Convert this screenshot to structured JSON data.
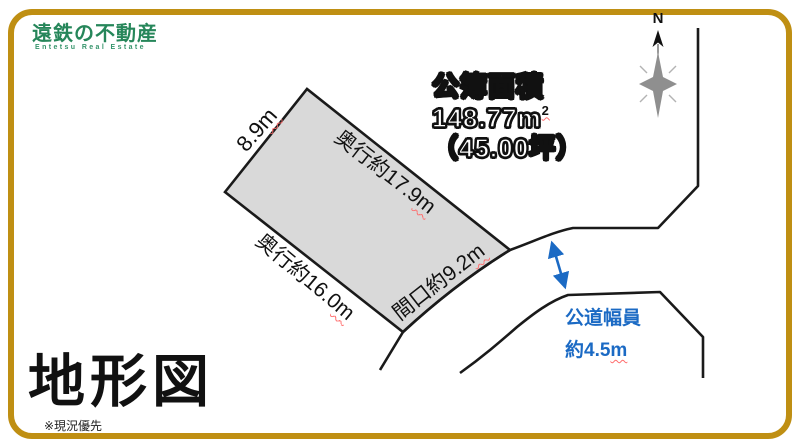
{
  "logo": {
    "jp": "遠鉄の不動産",
    "en": "Entetsu Real Estate"
  },
  "compass": {
    "label": "N"
  },
  "area": {
    "title": "公簿面積",
    "m2_value": "148.77m",
    "m2_sup": "2",
    "tsubo": "（45.00坪）"
  },
  "plot": {
    "edge_left": {
      "text": "8.9",
      "unit": "m"
    },
    "edge_top": {
      "text": "奥行約17.9",
      "unit": "m"
    },
    "edge_bottom_left": {
      "text": "奥行約16.0",
      "unit": "m"
    },
    "edge_front": {
      "text": "間口約9.2",
      "unit": "m"
    }
  },
  "road": {
    "width_label_line1": "公道幅員",
    "width_label_line2": "約4.5",
    "width_unit": "m"
  },
  "footer": {
    "title": "地形図",
    "note": "※現況優先"
  },
  "colors": {
    "frame_gold": "#bf8f13",
    "brand_green": "#26865a",
    "road_blue": "#1b6ac4",
    "plot_fill": "#d9d9d9",
    "line_black": "#1a1a1a"
  }
}
